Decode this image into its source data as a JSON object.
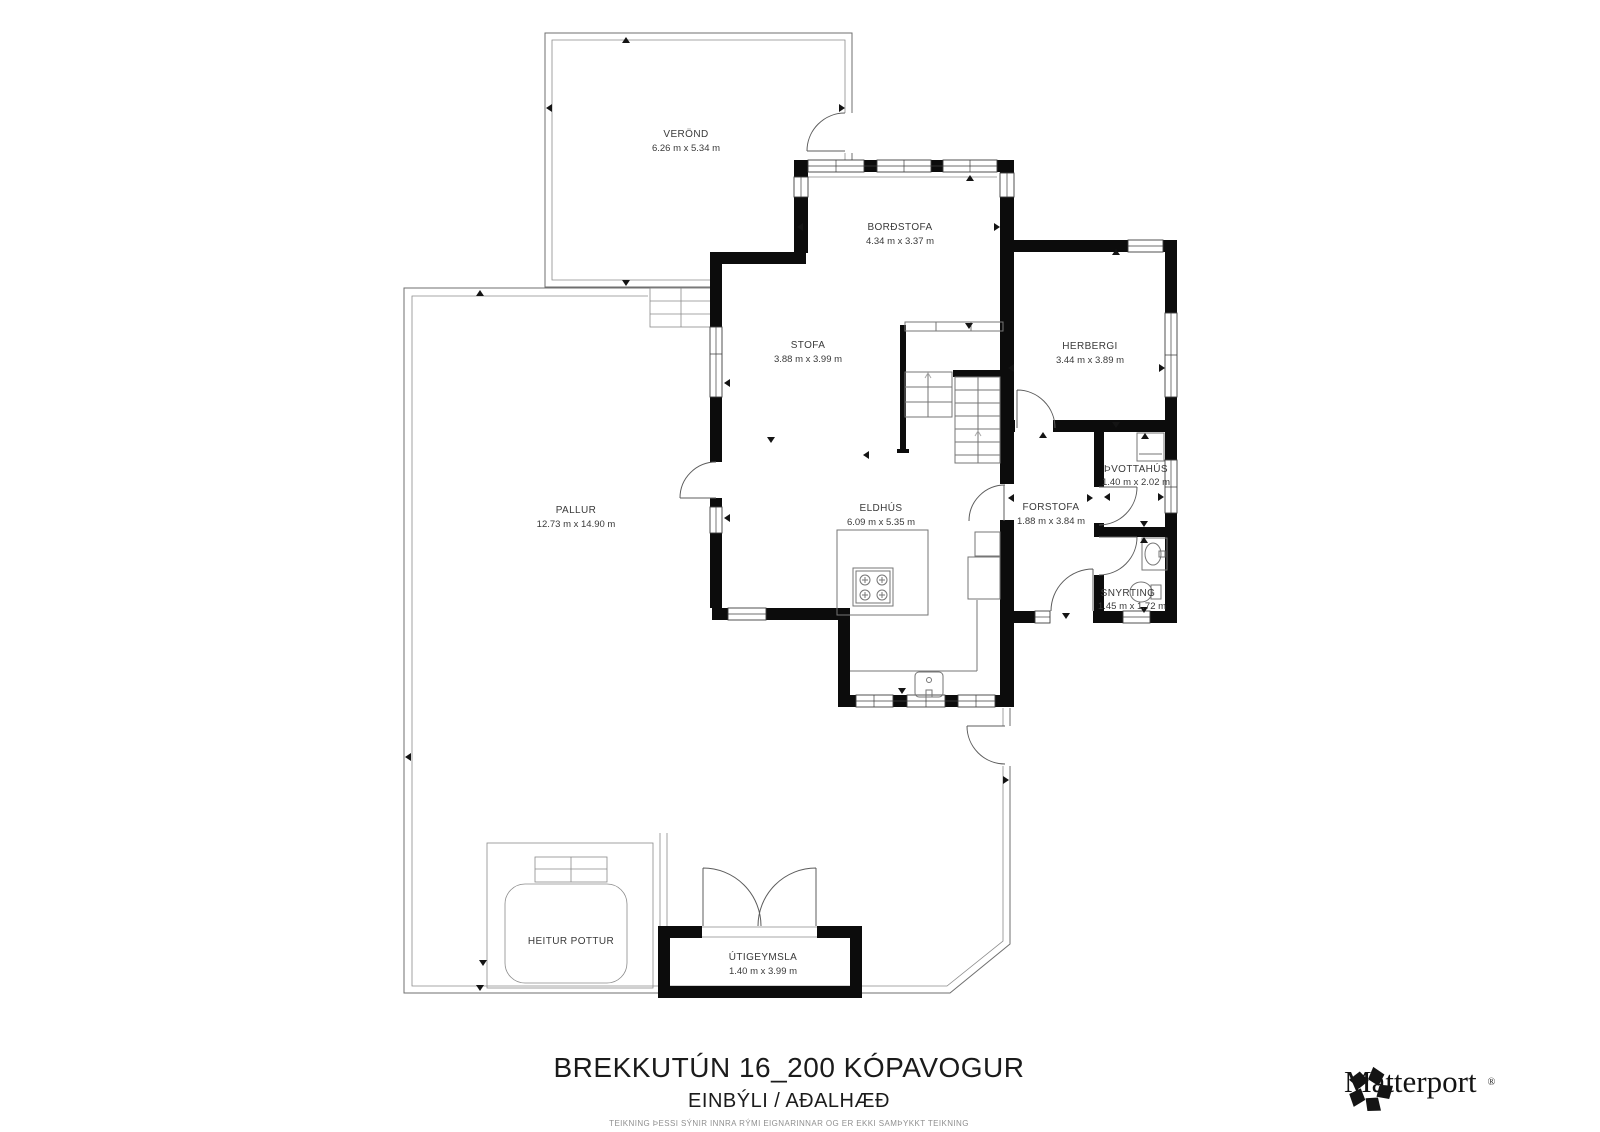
{
  "plan": {
    "rooms": [
      {
        "name": "VERÖND",
        "dims": "6.26 m x 5.34 m"
      },
      {
        "name": "BORÐSTOFA",
        "dims": "4.34 m x 3.37 m"
      },
      {
        "name": "STOFA",
        "dims": "3.88 m x 3.99 m"
      },
      {
        "name": "HERBERGI",
        "dims": "3.44 m x 3.89 m"
      },
      {
        "name": "PALLUR",
        "dims": "12.73 m x 14.90 m"
      },
      {
        "name": "ELDHÚS",
        "dims": "6.09 m x 5.35 m"
      },
      {
        "name": "FORSTOFA",
        "dims": "1.88 m x 3.84 m"
      },
      {
        "name": "ÞVOTTAHÚS",
        "dims": "1.40 m x 2.02 m"
      },
      {
        "name": "SNYRTING",
        "dims": "1.45 m x 1.72 m"
      },
      {
        "name": "HEITUR POTTUR",
        "dims": ""
      },
      {
        "name": "ÚTIGEYMSLA",
        "dims": "1.40 m x 3.99 m"
      }
    ],
    "icons": [
      "stove-icon",
      "kitchen-sink-icon",
      "bathroom-sink-icon",
      "toilet-icon",
      "washer-icon",
      "staircase",
      "hot-tub",
      "door-arc",
      "matterport-logo-icon"
    ]
  },
  "footer": {
    "title": "BREKKUTÚN 16_200 KÓPAVOGUR",
    "subtitle": "EINBÝLI / AÐALHÆÐ",
    "disclaimer": "TEIKNING ÞESSI SÝNIR INNRA RÝMI EIGNARINNAR OG ER EKKI SAMÞYKKT TEIKNING"
  },
  "branding": {
    "logo_text": "Matterport",
    "registered_mark": "®"
  },
  "colors": {
    "wall": "#0c0c0c",
    "thin_line": "#6f6f6f",
    "label": "#3a3a3a",
    "background": "#ffffff"
  }
}
